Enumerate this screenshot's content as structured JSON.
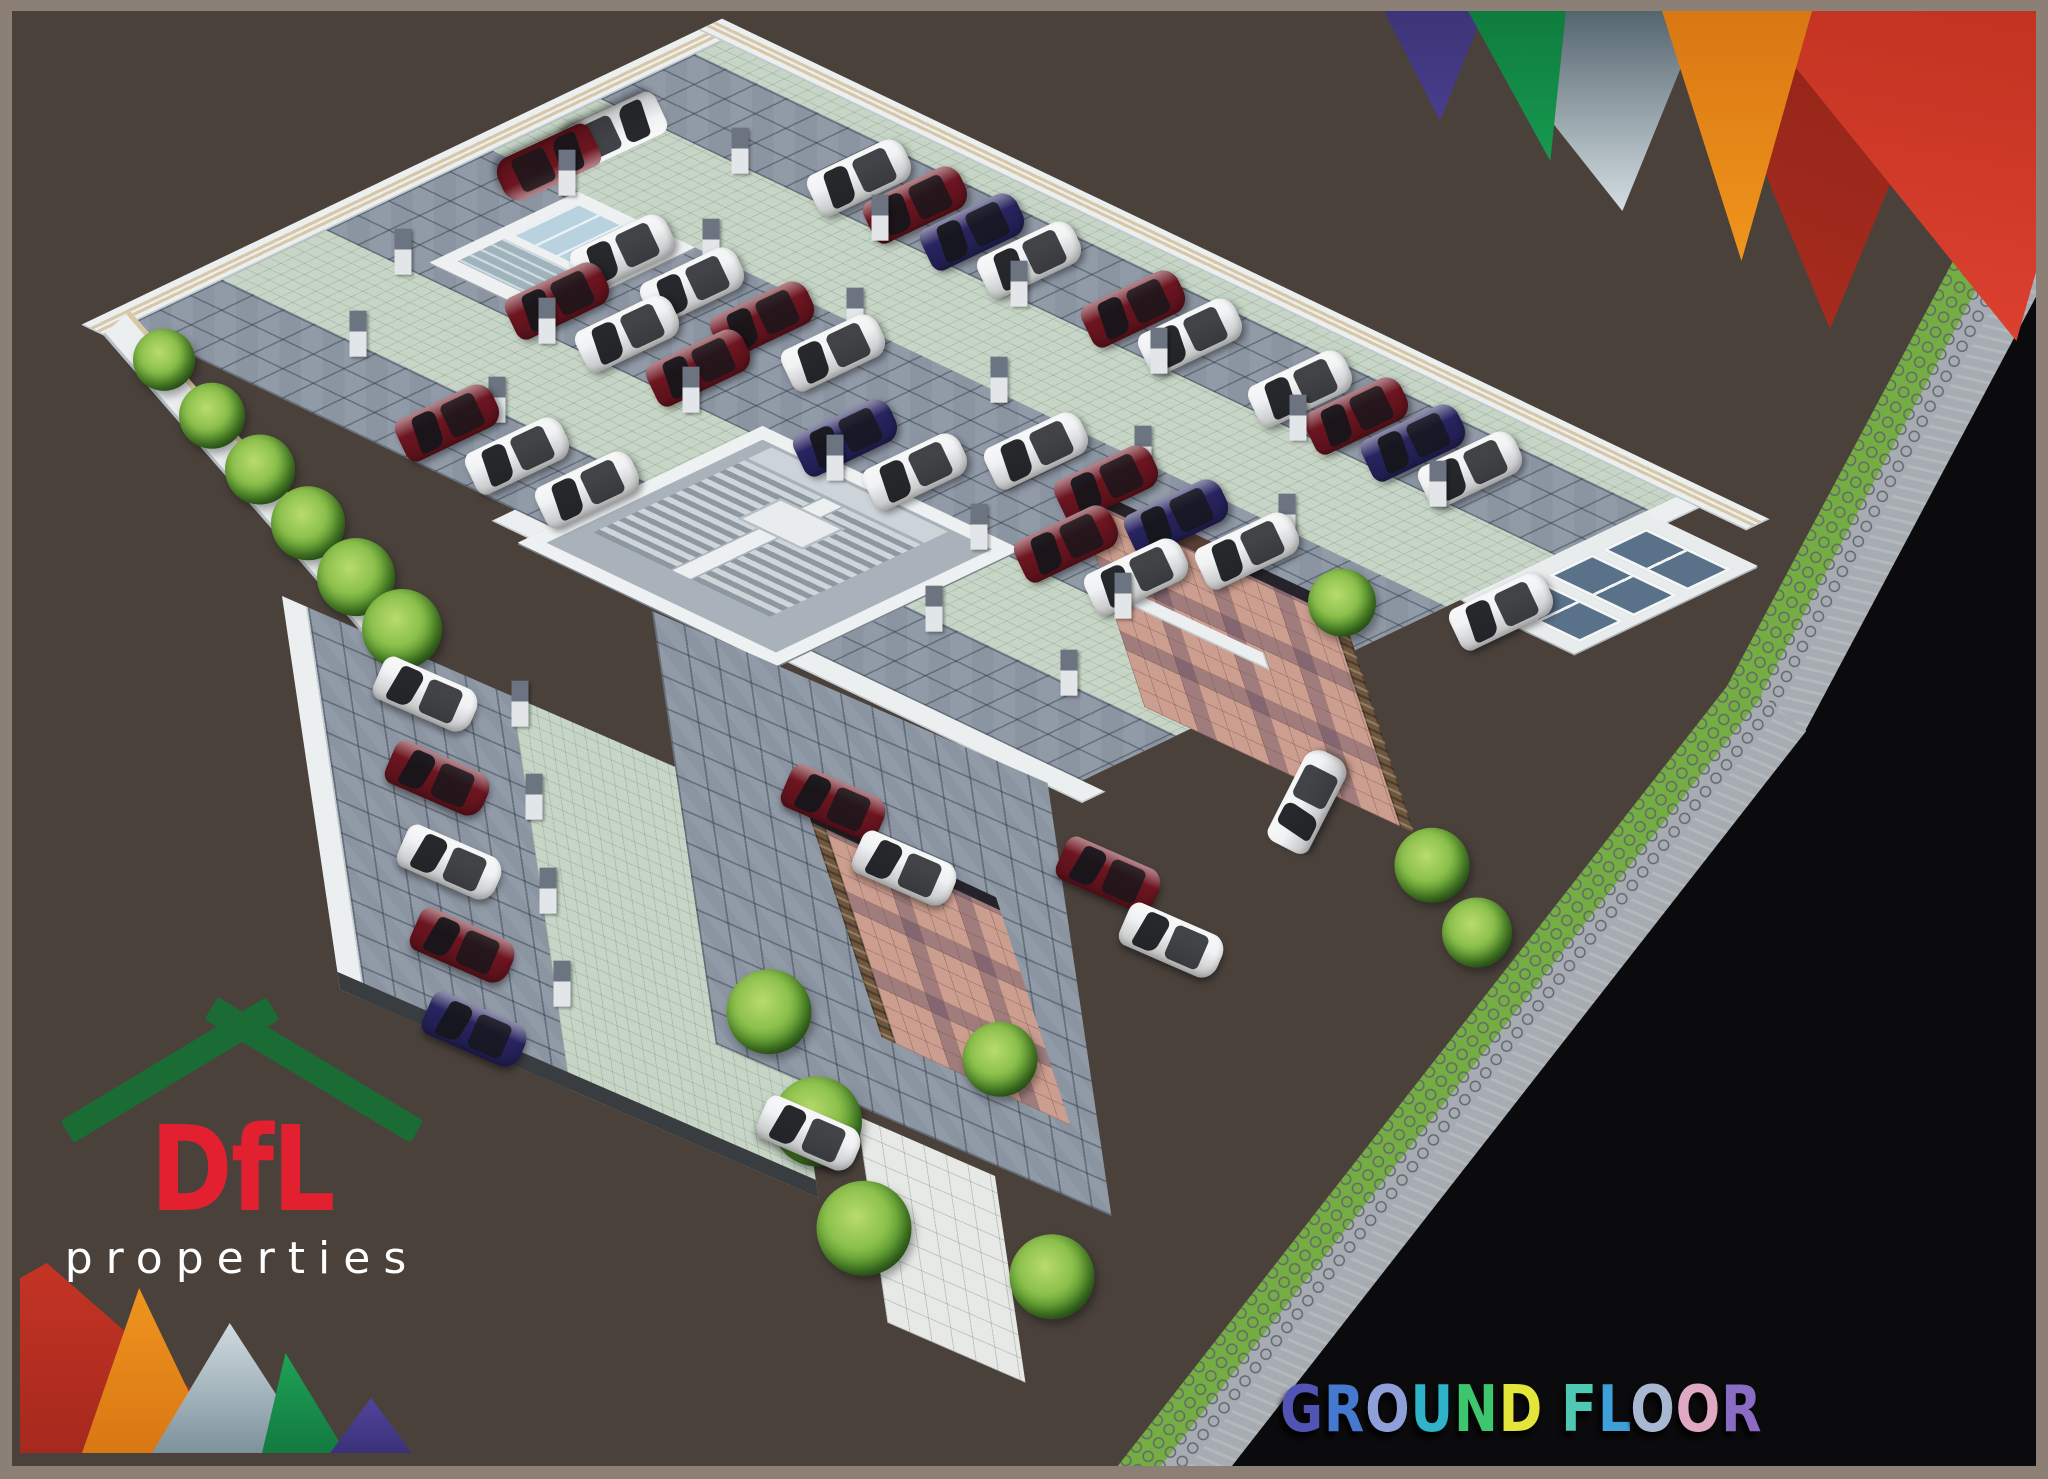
{
  "palette": {
    "bg": "#4a413b",
    "frame": "#8c8076",
    "black": "#0b0b0d",
    "aisle": "#c6d5c6",
    "lot": "#8b95a2",
    "wall": "#eceff0",
    "wallEdge": "#c3cacf",
    "tan": "#d8c7a6",
    "colDark": "#6b7480",
    "colLight": "#e2e6e9",
    "carWhite": "#f1f2f3",
    "carMaroon": "#6d1520",
    "carBlue": "#272460",
    "glass": "#15161a",
    "leaf1": "#8cc04c",
    "leaf2": "#2f6b1f",
    "court": "#cc9e90",
    "stone": "#6e563f",
    "grass": "#74ad41",
    "hex": "#a7acb2",
    "hexLine": "#63686e",
    "walkway": "#e7e9e7",
    "window": "#5a718a",
    "logoGreen": "#1b6b35",
    "logoRed": "#e32030",
    "triPurple": "#483d8c",
    "triGreen": "#17994f",
    "triGrayA": "#55656e",
    "triGrayB": "#d3dee2",
    "triOrangeA": "#d97713",
    "triOrangeB": "#f0951c",
    "triRedA": "#a92c1f",
    "triRedB": "#e04231"
  },
  "logo": {
    "name": "DfL",
    "sub": "properties"
  },
  "title": {
    "text": "GROUND FLOOR",
    "letters": [
      {
        "ch": "G",
        "color": "#5153b5"
      },
      {
        "ch": "R",
        "color": "#4579cf"
      },
      {
        "ch": "O",
        "color": "#8f9fd9"
      },
      {
        "ch": "U",
        "color": "#2fb3c9"
      },
      {
        "ch": "N",
        "color": "#3dc66e"
      },
      {
        "ch": "D",
        "color": "#e3e53a"
      },
      {
        "ch": " ",
        "color": ""
      },
      {
        "ch": "F",
        "color": "#4fc9b4"
      },
      {
        "ch": "L",
        "color": "#3da0d8"
      },
      {
        "ch": "O",
        "color": "#a8b8d3"
      },
      {
        "ch": "O",
        "color": "#dfa8c3"
      },
      {
        "ch": "R",
        "color": "#8a6cc5"
      }
    ]
  },
  "scene": {
    "car_colors": {
      "w": "#f1f2f3",
      "m": "#6d1520",
      "b": "#272460"
    },
    "hall": {
      "cars": [
        [
          45,
          165,
          "w",
          155
        ],
        [
          45,
          238,
          "m",
          155
        ],
        [
          235,
          82,
          "w"
        ],
        [
          298,
          82,
          "m"
        ],
        [
          361,
          82,
          "b"
        ],
        [
          424,
          82,
          "w"
        ],
        [
          540,
          82,
          "m"
        ],
        [
          603,
          82,
          "w"
        ],
        [
          725,
          82,
          "w"
        ],
        [
          788,
          82,
          "m"
        ],
        [
          851,
          82,
          "b"
        ],
        [
          914,
          82,
          "w"
        ],
        [
          190,
          300,
          "w"
        ],
        [
          268,
          300,
          "w"
        ],
        [
          346,
          300,
          "m"
        ],
        [
          424,
          300,
          "w"
        ],
        [
          650,
          300,
          "w"
        ],
        [
          728,
          300,
          "m"
        ],
        [
          806,
          300,
          "b"
        ],
        [
          884,
          300,
          "w"
        ],
        [
          210,
          392,
          "m"
        ],
        [
          288,
          392,
          "w"
        ],
        [
          366,
          392,
          "m"
        ],
        [
          530,
          392,
          "b"
        ],
        [
          608,
          392,
          "w"
        ],
        [
          775,
          392,
          "m"
        ],
        [
          853,
          392,
          "w"
        ],
        [
          290,
          595,
          "m"
        ],
        [
          368,
          595,
          "w"
        ],
        [
          446,
          595,
          "w"
        ]
      ],
      "columns": [
        [
          160,
          140
        ],
        [
          315,
          140
        ],
        [
          470,
          140
        ],
        [
          625,
          140
        ],
        [
          780,
          140
        ],
        [
          935,
          140
        ],
        [
          90,
          262
        ],
        [
          250,
          262
        ],
        [
          410,
          262
        ],
        [
          570,
          262
        ],
        [
          730,
          262
        ],
        [
          890,
          262
        ],
        [
          90,
          445
        ],
        [
          250,
          445
        ],
        [
          410,
          445
        ],
        [
          570,
          445
        ],
        [
          730,
          445
        ],
        [
          890,
          445
        ],
        [
          160,
          565
        ],
        [
          315,
          565
        ],
        [
          800,
          565
        ],
        [
          950,
          565
        ]
      ]
    },
    "annex": {
      "cars": [
        [
          150,
          40,
          "w"
        ],
        [
          150,
          125,
          "m"
        ],
        [
          150,
          210,
          "w"
        ],
        [
          150,
          295,
          "m"
        ],
        [
          150,
          380,
          "b"
        ]
      ],
      "columns": [
        [
          255,
          25
        ],
        [
          255,
          120
        ],
        [
          255,
          215
        ],
        [
          255,
          310
        ]
      ]
    },
    "extra_cars": [
      [
        1490,
        600,
        "w",
        -25.5
      ],
      [
        1296,
        790,
        "w",
        -63
      ],
      [
        822,
        792,
        "m",
        23.5
      ],
      [
        893,
        858,
        "w",
        23.5
      ],
      [
        1097,
        864,
        "m",
        23.5
      ],
      [
        1160,
        930,
        "w",
        23.5
      ],
      [
        797,
        1123,
        "w",
        23.5
      ]
    ],
    "plants": [
      [
        152,
        352,
        62
      ],
      [
        200,
        408,
        66
      ],
      [
        248,
        462,
        70
      ],
      [
        296,
        516,
        74
      ],
      [
        344,
        570,
        78
      ],
      [
        390,
        622,
        80
      ],
      [
        757,
        1005,
        85
      ],
      [
        805,
        1115,
        90
      ],
      [
        852,
        1222,
        95
      ],
      [
        1040,
        1270,
        85
      ],
      [
        1420,
        858,
        75
      ],
      [
        1465,
        925,
        70
      ],
      [
        1330,
        595,
        68
      ],
      [
        988,
        1052,
        75
      ]
    ]
  }
}
